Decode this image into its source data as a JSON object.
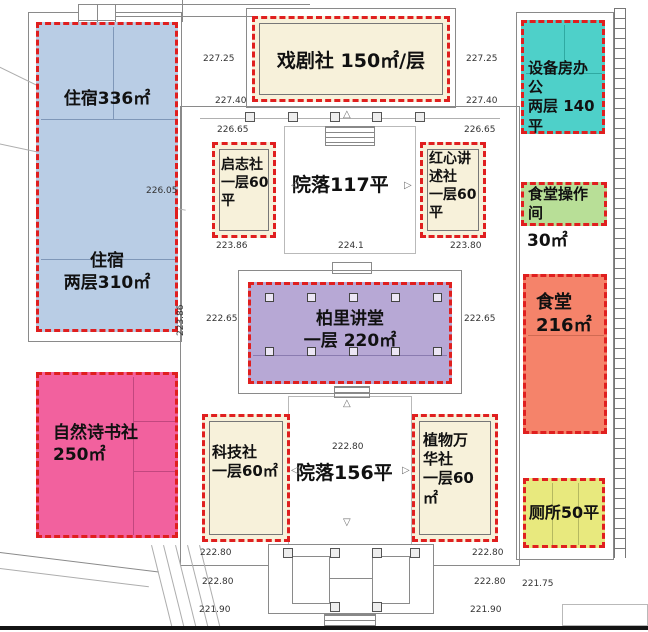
{
  "colors": {
    "dashed_border": "#e01f1f",
    "dorm_blue": "#b9cde5",
    "club_cream": "#f7f1da",
    "equipment_teal": "#4ed0c9",
    "kitchen_green": "#b8df97",
    "canteen_orange": "#f5836a",
    "nature_pink": "#f2619e",
    "hall_purple": "#b7a8d5",
    "toilet_yellow": "#e8e97e"
  },
  "zones": {
    "dorm336": {
      "label": "住宿336㎡",
      "color": "#b9cde5"
    },
    "dorm310": {
      "label": "住宿\n两层310㎡",
      "color": "#b9cde5"
    },
    "drama": {
      "label": "戏剧社 150㎡/层",
      "color": "#f7f1da"
    },
    "equipment": {
      "label": "设备房办公\n两层 140平",
      "color": "#4ed0c9"
    },
    "qizhi": {
      "label": "启志社\n一层60\n平",
      "color": "#f7f1da"
    },
    "hongxin": {
      "label": "红心讲\n述社\n一层60\n平",
      "color": "#f7f1da"
    },
    "hall": {
      "label": "柏里讲堂\n一层  220㎡",
      "color": "#b7a8d5"
    },
    "canteen_op": {
      "label": "食堂操作\n间",
      "outside_label": "30㎡",
      "color": "#b8df97"
    },
    "canteen": {
      "label": "食堂\n216㎡",
      "color": "#f5836a"
    },
    "nature": {
      "label": "自然诗书社\n250㎡",
      "color": "#f2619e"
    },
    "tech": {
      "label": "科技社\n一层60㎡",
      "color": "#f7f1da"
    },
    "plant": {
      "label": "植物万\n华社\n一层60\n㎡",
      "color": "#f7f1da"
    },
    "toilet": {
      "label": "厕所50平",
      "color": "#e8e97e"
    }
  },
  "courtyards": {
    "upper": "院落117平",
    "lower": "院落156平"
  },
  "elevations": {
    "tl_1": "227.25",
    "tl_2": "227.40",
    "tl_3": "226.65",
    "tr_1": "227.25",
    "tr_2": "227.40",
    "tr_3": "226.65",
    "ml_1": "223.86",
    "ml_rot": "223.86",
    "ml_2": "222.65",
    "mr_1": "223.80",
    "mr_2": "222.65",
    "left_edge": "226.05",
    "c_1": "224.1",
    "c_2": "222.80",
    "bl_1": "222.80",
    "bl_2": "222.80",
    "bl_3": "221.90",
    "br_1": "222.80",
    "br_2": "222.80",
    "br_3": "221.90",
    "br_4": "221.75"
  },
  "markers": {
    "left": "◁",
    "right": "▷",
    "up": "△",
    "down": "▽"
  }
}
